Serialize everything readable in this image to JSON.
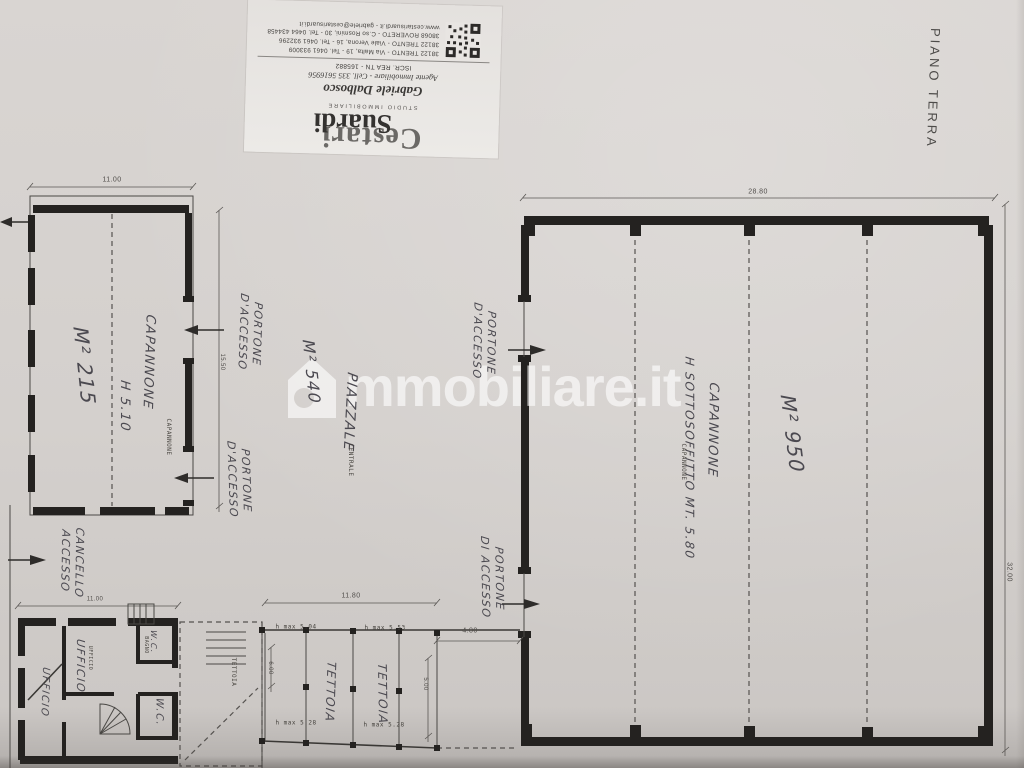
{
  "palette": {
    "paper_hex": "#d3cfcc",
    "ink_hex": "#242220",
    "handwriting_hex": "#4b4950",
    "watermark_hex": "#ffffff"
  },
  "orientation_label": {
    "text": "PIANO TERRA"
  },
  "watermark": {
    "icon": "house-icon",
    "text": "mmobiliare.it"
  },
  "stamp": {
    "logo_line1": "Cestari",
    "logo_line2": "Suardi",
    "logo_sub": "STUDIO IMMOBILIARE",
    "agent_name": "Gabriele Dalbosco",
    "agent_role": "Agente Immobiliare - Cell. 335 5616956",
    "registration": "ISCR. REA TN - 165882",
    "addresses": [
      "38122 TRENTO - Via Malta, 19 - Tel. 0461 933009",
      "38122 TRENTO - Viale Verona, 16 - Tel. 0461 932296",
      "38068 ROVERETO - C.so Rosmini, 30 - Tel. 0464 434458",
      "www.cestarisuardi.it - gabriele@cestarisuardi.it"
    ]
  },
  "plan": {
    "labels": [
      {
        "name": "label-capannone-left",
        "text": "CAPANNONE",
        "x": 148,
        "y": 362,
        "rot": 92,
        "size": 13,
        "cls": "hand"
      },
      {
        "name": "label-h-left",
        "text": "H 5.10",
        "x": 124,
        "y": 406,
        "rot": 90,
        "size": 13,
        "cls": "hand"
      },
      {
        "name": "label-m2-left",
        "text": "M² 215",
        "x": 84,
        "y": 366,
        "rot": 84,
        "size": 20,
        "cls": "hand"
      },
      {
        "name": "label-portone-1",
        "text": "PORTONE\nD'ACCESSO",
        "x": 250,
        "y": 333,
        "rot": 92,
        "size": 11,
        "cls": "hand"
      },
      {
        "name": "label-portone-2",
        "text": "PORTONE\nD'ACCESSO",
        "x": 239,
        "y": 480,
        "rot": 88,
        "size": 11,
        "cls": "hand"
      },
      {
        "name": "label-piazzale",
        "text": "PIAZZALE",
        "x": 349,
        "y": 412,
        "rot": 93,
        "size": 14,
        "cls": "hand"
      },
      {
        "name": "label-m2-piazzale",
        "text": "M² 540",
        "x": 311,
        "y": 372,
        "rot": 84,
        "size": 16,
        "cls": "hand"
      },
      {
        "name": "label-portone-3",
        "text": "PORTONE\nD'ACCESSO",
        "x": 484,
        "y": 342,
        "rot": 91,
        "size": 11,
        "cls": "hand"
      },
      {
        "name": "label-portone-4",
        "text": "PORTONE\nDI ACCESSO",
        "x": 492,
        "y": 578,
        "rot": 89,
        "size": 11,
        "cls": "hand"
      },
      {
        "name": "label-capannone-right",
        "text": "CAPANNONE",
        "x": 712,
        "y": 430,
        "rot": 91,
        "size": 13,
        "cls": "hand"
      },
      {
        "name": "label-sottosoffitto",
        "text": "H SOTTOSOFFITTO MT. 5.80",
        "x": 689,
        "y": 458,
        "rot": 90,
        "size": 12,
        "cls": "hand"
      },
      {
        "name": "label-m2-right",
        "text": "M² 950",
        "x": 792,
        "y": 434,
        "rot": 83,
        "size": 20,
        "cls": "hand"
      },
      {
        "name": "label-cancello",
        "text": "CANCELLO\nACCESSO",
        "x": 72,
        "y": 562,
        "rot": 91,
        "size": 11,
        "cls": "hand"
      },
      {
        "name": "label-ufficio-1",
        "text": "UFFICIO",
        "x": 44,
        "y": 692,
        "rot": 92,
        "size": 10,
        "cls": "hand"
      },
      {
        "name": "label-ufficio-2",
        "text": "UFFICIO",
        "x": 80,
        "y": 666,
        "rot": 90,
        "size": 11,
        "cls": "hand"
      },
      {
        "name": "label-wc-1",
        "text": "W.C.",
        "x": 153,
        "y": 642,
        "rot": 90,
        "size": 8,
        "cls": "hand"
      },
      {
        "name": "label-wc-2",
        "text": "W.C.",
        "x": 158,
        "y": 712,
        "rot": 90,
        "size": 10,
        "cls": "hand"
      },
      {
        "name": "label-tettoia-1",
        "text": "TETTOIA",
        "x": 330,
        "y": 692,
        "rot": 92,
        "size": 12,
        "cls": "hand"
      },
      {
        "name": "label-tettoia-2",
        "text": "TETTOIA",
        "x": 382,
        "y": 694,
        "rot": 89,
        "size": 12,
        "cls": "hand"
      },
      {
        "name": "typed-capannone-left",
        "text": "CAPANNONE",
        "x": 168,
        "y": 437,
        "rot": 90,
        "size": 6,
        "cls": "typed"
      },
      {
        "name": "typed-capannone-right",
        "text": "CAPANNONE",
        "x": 683,
        "y": 462,
        "rot": 90,
        "size": 6,
        "cls": "typed"
      },
      {
        "name": "typed-centrale",
        "text": "CENTRALE",
        "x": 350,
        "y": 460,
        "rot": 90,
        "size": 6,
        "cls": "typed"
      },
      {
        "name": "typed-ufficio",
        "text": "UFFICIO",
        "x": 90,
        "y": 658,
        "rot": 90,
        "size": 5,
        "cls": "typed"
      },
      {
        "name": "typed-bagno",
        "text": "BAGNO",
        "x": 146,
        "y": 645,
        "rot": 90,
        "size": 5,
        "cls": "typed"
      },
      {
        "name": "typed-tettoia",
        "text": "TETTOIA",
        "x": 233,
        "y": 672,
        "rot": 90,
        "size": 6,
        "cls": "typed"
      },
      {
        "name": "typed-hmax-1",
        "text": "h max 5.04",
        "x": 296,
        "y": 627,
        "rot": 0,
        "size": 6,
        "cls": "typed"
      },
      {
        "name": "typed-hmax-2",
        "text": "h max 5.53",
        "x": 385,
        "y": 628,
        "rot": 0,
        "size": 6,
        "cls": "typed"
      },
      {
        "name": "typed-hmax-3",
        "text": "h max 5.28",
        "x": 296,
        "y": 723,
        "rot": 0,
        "size": 6,
        "cls": "typed"
      },
      {
        "name": "typed-hmax-4",
        "text": "h max 5.28",
        "x": 384,
        "y": 725,
        "rot": 0,
        "size": 6,
        "cls": "typed"
      },
      {
        "name": "dim-width-left-building",
        "text": "11.00",
        "x": 112,
        "y": 181,
        "rot": 0,
        "size": 7,
        "cls": "dim"
      },
      {
        "name": "dim-depth-left-building",
        "text": "15.50",
        "x": 221,
        "y": 362,
        "rot": 90,
        "size": 6,
        "cls": "dim"
      },
      {
        "name": "dim-width-right-building",
        "text": "28.80",
        "x": 758,
        "y": 193,
        "rot": 0,
        "size": 7,
        "cls": "dim"
      },
      {
        "name": "dim-depth-right-building",
        "text": "32.00",
        "x": 1008,
        "y": 572,
        "rot": 90,
        "size": 7,
        "cls": "dim"
      },
      {
        "name": "dim-tettoia-width",
        "text": "11.80",
        "x": 351,
        "y": 597,
        "rot": 0,
        "size": 7,
        "cls": "dim"
      },
      {
        "name": "dim-gap",
        "text": "4.80",
        "x": 470,
        "y": 632,
        "rot": 0,
        "size": 7,
        "cls": "dim"
      },
      {
        "name": "dim-tettoia-depth-1",
        "text": "6.00",
        "x": 269,
        "y": 668,
        "rot": 90,
        "size": 6,
        "cls": "dim"
      },
      {
        "name": "dim-tettoia-depth-2",
        "text": "5.00",
        "x": 424,
        "y": 684,
        "rot": 90,
        "size": 6,
        "cls": "dim"
      },
      {
        "name": "dim-office-width",
        "text": "11.00",
        "x": 95,
        "y": 600,
        "rot": 0,
        "size": 6,
        "cls": "dim"
      }
    ]
  }
}
